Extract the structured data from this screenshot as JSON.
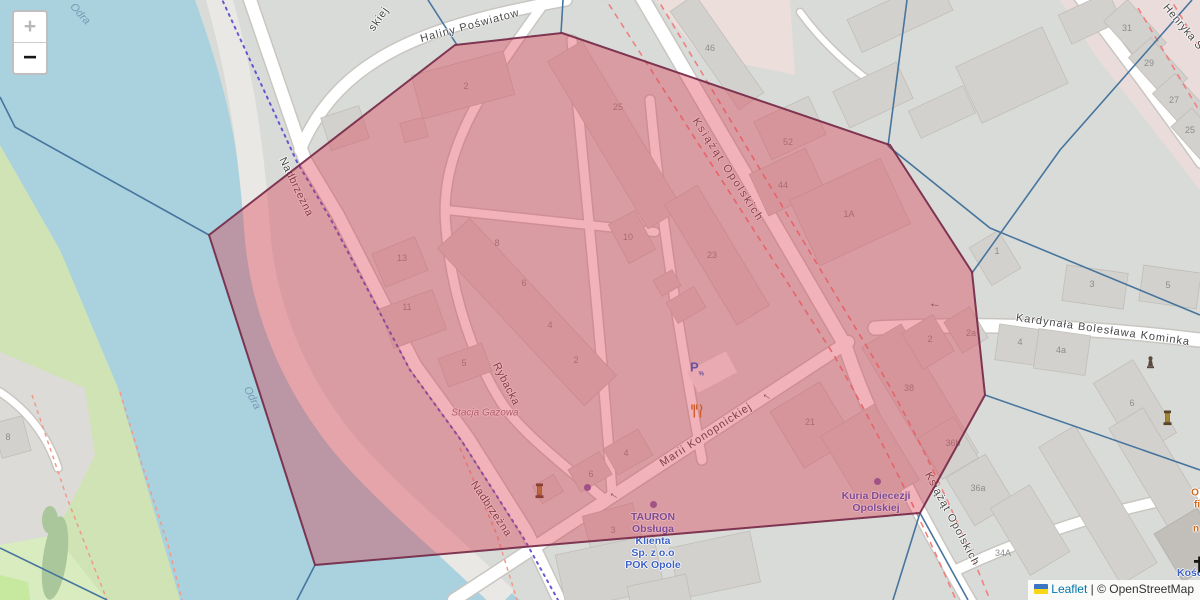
{
  "controls": {
    "zoom_in": "+",
    "zoom_out": "−"
  },
  "attribution": {
    "leaflet": "Leaflet",
    "separator": "|",
    "copyright": "© OpenStreetMap"
  },
  "overlay": {
    "fill": "#d9344a",
    "fill_opacity": 0.38,
    "stroke": "#732746",
    "points": [
      [
        209,
        235
      ],
      [
        455,
        45
      ],
      [
        562,
        33
      ],
      [
        890,
        145
      ],
      [
        972,
        272
      ],
      [
        985,
        395
      ],
      [
        920,
        513
      ],
      [
        315,
        565
      ]
    ]
  },
  "colors": {
    "water": "#a9d2de",
    "land": "#d9dbd8",
    "green": "#cfe3b4",
    "green_light": "#d9ecbf",
    "building": "#d3d1cd",
    "road": "#ffffff",
    "casing": "#c9c6c1",
    "admin_line": "#47759e",
    "admin_dash": "#5847cf",
    "construction_dash": "#ef8080",
    "footway_dash": "#f09a8a",
    "poi_blue": "#3c60c4",
    "poi_orange": "#cf6a1e"
  },
  "map": {
    "street_labels": [
      {
        "t": "Haliny Poświatow",
        "x": 470,
        "y": 26,
        "r": -15,
        "ls": 1
      },
      {
        "t": "skiej",
        "x": 379,
        "y": 19,
        "r": -55,
        "ls": 1
      },
      {
        "t": "Książąt Opolskich",
        "x": 728,
        "y": 170,
        "r": 57,
        "ls": 2
      },
      {
        "t": "Książąt Opolskich",
        "x": 952,
        "y": 519,
        "r": 62,
        "ls": 1
      },
      {
        "t": "Kardynała Bolesława Kominka",
        "x": 1103,
        "y": 330,
        "r": 8,
        "ls": 1
      },
      {
        "t": "Marii Konopnickiej",
        "x": 706,
        "y": 435,
        "r": -33,
        "ls": 1
      },
      {
        "t": "Nadbrzeżna",
        "x": 296,
        "y": 187,
        "r": 64,
        "ls": 0.5
      },
      {
        "t": "Nadbrzeżna",
        "x": 491,
        "y": 509,
        "r": 56,
        "ls": 0.5
      },
      {
        "t": "Rybacka",
        "x": 506,
        "y": 384,
        "r": 63,
        "ls": 0.5
      },
      {
        "t": "Henryka S",
        "x": 1183,
        "y": 27,
        "r": 50,
        "ls": 0.5
      }
    ],
    "water_labels": [
      {
        "t": "Odra",
        "x": 80,
        "y": 14,
        "r": 48
      },
      {
        "t": "Odra",
        "x": 252,
        "y": 398,
        "r": 62
      }
    ],
    "area_labels": [
      {
        "t": "Stacja Gazowa",
        "x": 485,
        "y": 413,
        "r": 0
      }
    ],
    "poi_labels": [
      {
        "name": "tauron-label",
        "x": 653,
        "y": 517,
        "lh": 12,
        "lines": [
          "TAURON",
          "Obsługa",
          "Klienta",
          "Sp. z o.o",
          "POK Opole"
        ]
      },
      {
        "name": "kuria-label",
        "x": 876,
        "y": 496,
        "lh": 12,
        "lines": [
          "Kuria Diecezji",
          "Opolskiej"
        ]
      },
      {
        "name": "church-label",
        "x": 1196,
        "y": 573,
        "lh": 12,
        "lines": [
          "Kościół"
        ]
      }
    ],
    "poi_fragments": [
      {
        "t": "O",
        "x": 1195,
        "y": 493
      },
      {
        "t": "fi",
        "x": 1197,
        "y": 505
      },
      {
        "t": "n",
        "x": 1196,
        "y": 529
      }
    ],
    "house_numbers": [
      [
        466,
        86,
        "2"
      ],
      [
        618,
        107,
        "25"
      ],
      [
        710,
        48,
        "46"
      ],
      [
        788,
        142,
        "52"
      ],
      [
        783,
        185,
        "44"
      ],
      [
        849,
        214,
        "1A"
      ],
      [
        497,
        243,
        "8"
      ],
      [
        402,
        258,
        "13"
      ],
      [
        628,
        237,
        "10"
      ],
      [
        712,
        255,
        "23"
      ],
      [
        524,
        283,
        "6"
      ],
      [
        407,
        307,
        "11"
      ],
      [
        550,
        325,
        "4"
      ],
      [
        576,
        360,
        "2"
      ],
      [
        464,
        363,
        "5"
      ],
      [
        997,
        251,
        "1"
      ],
      [
        930,
        339,
        "2"
      ],
      [
        971,
        333,
        "2a"
      ],
      [
        909,
        388,
        "38"
      ],
      [
        1092,
        284,
        "3"
      ],
      [
        1168,
        285,
        "5"
      ],
      [
        1020,
        342,
        "4"
      ],
      [
        1061,
        350,
        "4a"
      ],
      [
        1132,
        403,
        "6"
      ],
      [
        1127,
        28,
        "31"
      ],
      [
        1149,
        63,
        "29"
      ],
      [
        1174,
        100,
        "27"
      ],
      [
        1190,
        130,
        "25"
      ],
      [
        626,
        453,
        "4"
      ],
      [
        591,
        474,
        "6"
      ],
      [
        613,
        530,
        "3"
      ],
      [
        810,
        422,
        "21"
      ],
      [
        953,
        443,
        "36b"
      ],
      [
        978,
        488,
        "36a"
      ],
      [
        1003,
        553,
        "34A"
      ],
      [
        8,
        437,
        "8"
      ]
    ],
    "icons": {
      "parking": {
        "x": 697,
        "y": 371,
        "glyph": "P",
        "sub": "%"
      },
      "restaurant": {
        "x": 690,
        "y": 404
      },
      "memorials": [
        {
          "x": 535,
          "y": 483
        },
        {
          "x": 1163,
          "y": 410
        }
      ],
      "monument": {
        "x": 1146,
        "y": 356
      },
      "poi_dots": [
        {
          "x": 587,
          "y": 487
        },
        {
          "x": 653,
          "y": 504
        },
        {
          "x": 877,
          "y": 481
        }
      ],
      "church_cross": {
        "x": 1192,
        "y": 556
      },
      "oneway_arrows": [
        {
          "x": 935,
          "y": 303,
          "r": 5
        },
        {
          "x": 768,
          "y": 395,
          "r": 33
        },
        {
          "x": 615,
          "y": 494,
          "r": 33
        }
      ]
    }
  }
}
